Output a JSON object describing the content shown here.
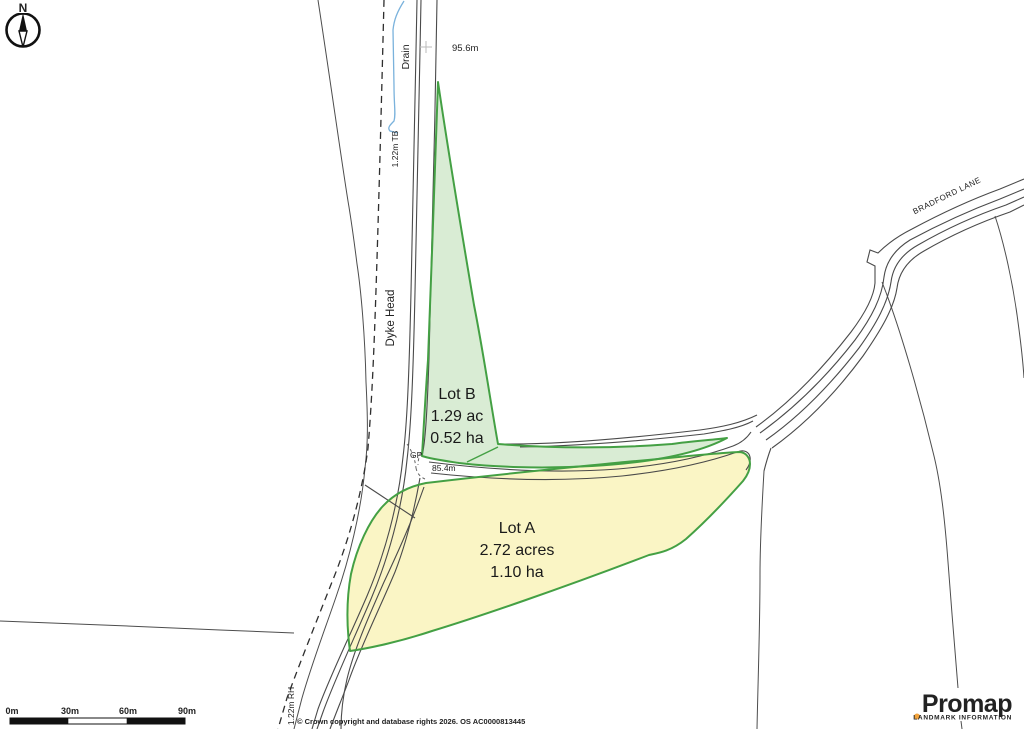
{
  "compass": {
    "north_label": "N"
  },
  "map": {
    "annotations": {
      "spot_height_top": "95.6m",
      "spot_height_mid": "85.4m",
      "gp": "GP",
      "dyke_head": "Dyke Head",
      "drain": "Drain",
      "fence_tb": "1.22m TB",
      "fence_rh": "1.22m RH",
      "road_name": "BRADFORD LANE"
    },
    "lots": [
      {
        "id": "B",
        "title": "Lot B",
        "area_acres": "1.29 ac",
        "area_ha": "0.52 ha",
        "fill": "#d9ecd4",
        "outline": "#44a044"
      },
      {
        "id": "A",
        "title": "Lot A",
        "area_acres": "2.72 acres",
        "area_ha": "1.10 ha",
        "fill": "#faf5c5",
        "outline": "#44a044"
      }
    ]
  },
  "scale_bar": {
    "ticks": [
      "0m",
      "30m",
      "60m",
      "90m"
    ]
  },
  "footer": {
    "copyright": "© Crown copyright and database rights 2026. OS AC0000813445"
  },
  "branding": {
    "logo": "Promap",
    "tagline": "LANDMARK INFORMATION",
    "dot_color": "#f2a33c"
  },
  "palette": {
    "lot_outline_green": "#44a044",
    "lot_b_fill": "#d9ecd4",
    "lot_a_fill": "#faf5c5",
    "drain_blue": "#4898d0",
    "fence_magenta": "#e23ad6",
    "linework_gray": "#4d4d4d"
  }
}
